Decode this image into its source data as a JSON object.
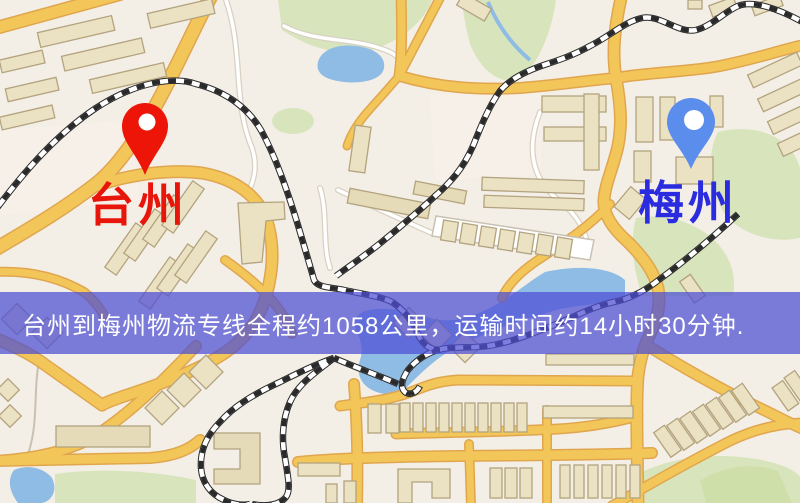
{
  "banner": {
    "text": "台州到梅州物流专线全程约1058公里，运输时间约14小时30分钟.",
    "background": "rgba(77,78,212,0.73)",
    "text_color": "#ffffff"
  },
  "markers": {
    "origin": {
      "label": "台州",
      "pin_color": "#ec1508",
      "label_color": "#e8150b"
    },
    "destination": {
      "label": "梅州",
      "pin_color": "#5b8ded",
      "label_color": "#2b2ce0"
    }
  },
  "palette": {
    "map_background": "#f4efe6",
    "road_yellow": "#f3c659",
    "road_casing": "#e0a64f",
    "building_fill": "#ebe2c4",
    "building_outline": "#b3a37e",
    "park_green": "#d8e5bc",
    "water_blue": "#8fbce4",
    "railway_black": "#2a2a2a"
  }
}
